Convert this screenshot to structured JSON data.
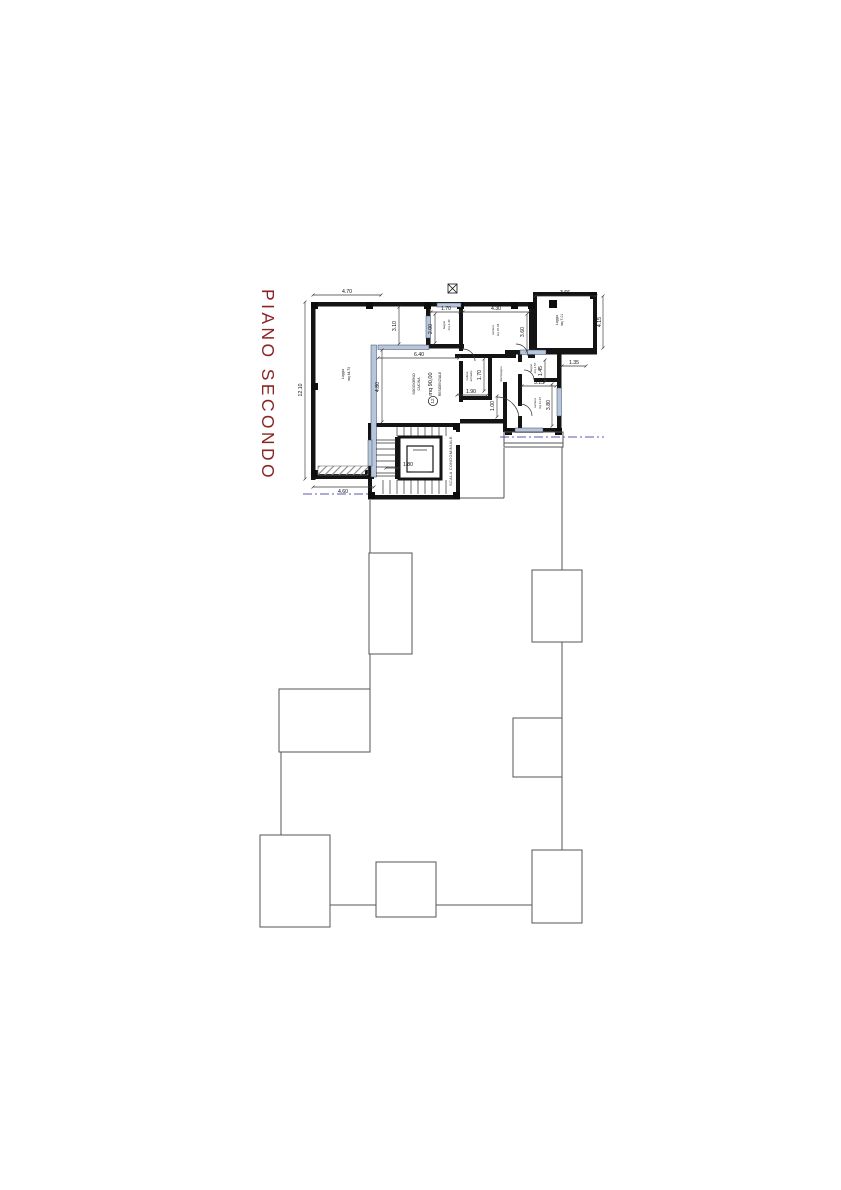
{
  "title": "PIANO SECONDO",
  "colors": {
    "title": "#8b2423",
    "wall": "#141414",
    "glazing": "#b8c6da",
    "section_line": "#7b7bc4",
    "outline": "#555555"
  },
  "labels": {
    "scala": "SCALA CONDOMINIALE",
    "residenziale": "RESIDENZIALE",
    "area_total": "mq 90,00",
    "unit_number": "12",
    "soggiorno_l1": "SOGGIORNO",
    "soggiorno_l2": "CUCINA"
  },
  "rooms": {
    "loggia_left": {
      "name": "Loggia",
      "area": "mq 44.73"
    },
    "loggia_right": {
      "name": "Loggia",
      "area": "mq 7.01"
    },
    "bagno_top": {
      "name": "bagno",
      "area": "mq 3.40"
    },
    "camera_top": {
      "name": "camera",
      "area": "mq 15.48"
    },
    "cabina": {
      "name": "cabina",
      "area": "armadio"
    },
    "disimpegno": {
      "name": "disimpegno"
    },
    "bagno_right": {
      "name": "bagno",
      "area": "mq 4.57"
    },
    "camera_right": {
      "name": "camera",
      "area": "mq 11.97"
    }
  },
  "dims": {
    "w_loggia": "4.70",
    "h_loggia": "12.10",
    "w_loggia_bottom": "4.60",
    "gap_top": "3.10",
    "h_soggiorno": "4.80",
    "w_soggiorno": "6.40",
    "w_bagno": "1.70",
    "h_bagno": "2.00",
    "w_camera": "4.30",
    "h_camera": "3.60",
    "w_loggia_r": "3.66",
    "h_loggia_r": "4.15",
    "offset_r": "1.35",
    "h_bagno_r": "1.45",
    "w_bagno_r": "3.15",
    "w_cabina": "1.90",
    "h_cabina": "1.70",
    "w_disimpegno": "1.00",
    "h_camera_r": "3.80",
    "w_elevator": "1.80"
  }
}
